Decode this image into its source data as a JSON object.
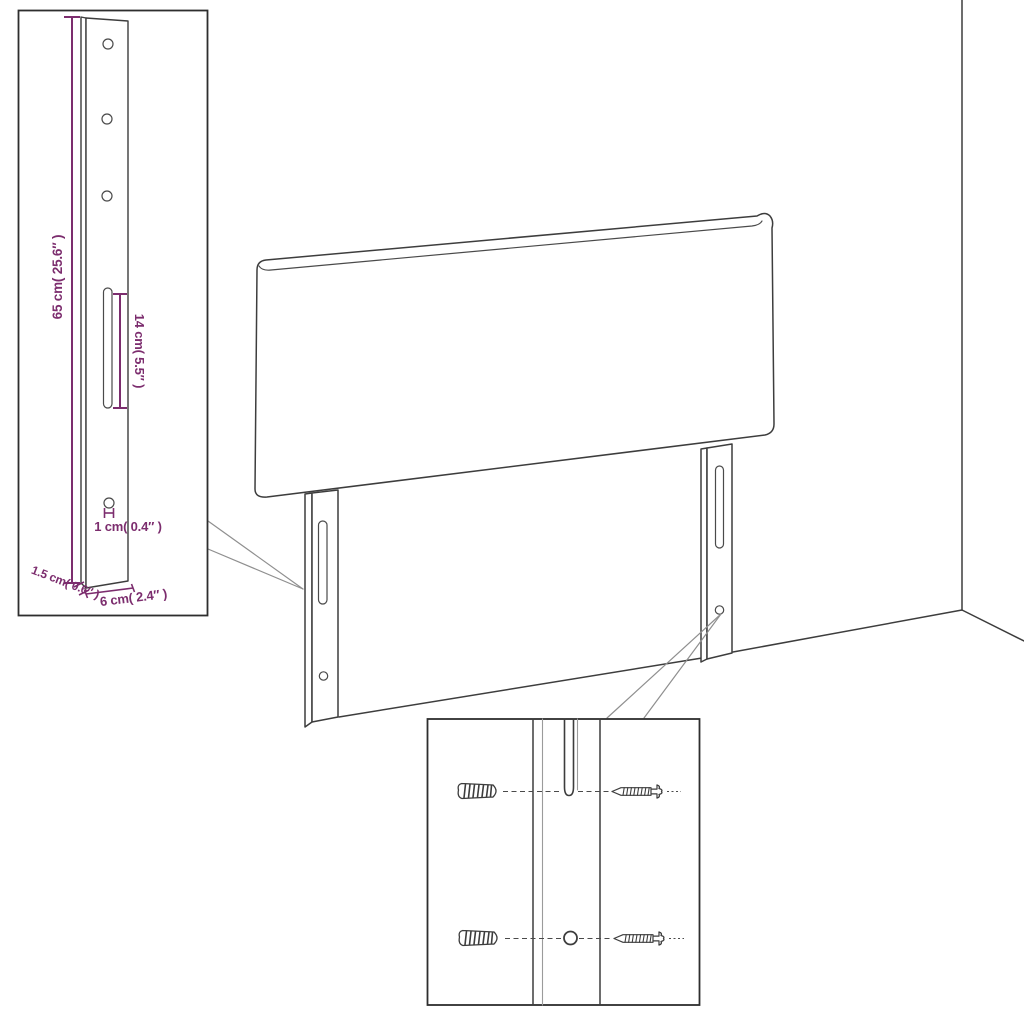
{
  "page": {
    "type": "product-dimension-diagram",
    "subject": "headboard with mounting legs in room corner",
    "background": "#ffffff"
  },
  "colors": {
    "line_dark": "#3d3d3d",
    "line_light": "#9b9b9b",
    "callout_line": "#8f8f8f",
    "inset_border": "#2e2e2e",
    "dimension": "#7c2d6e",
    "background": "#ffffff"
  },
  "bracket_inset": {
    "labels": {
      "height": "65 cm( 25.6″ )",
      "slot": "14 cm( 5.5″ )",
      "hole": "1 cm( 0.4″ )",
      "thickness": "1.5 cm( 0.6″ )",
      "width": "6 cm( 2.4″ )"
    },
    "hole_count": 3
  },
  "hardware_inset": {
    "icons": [
      "wall-plug-icon",
      "screw-icon"
    ],
    "wall_plug_count": 2,
    "screw_count": 2
  }
}
